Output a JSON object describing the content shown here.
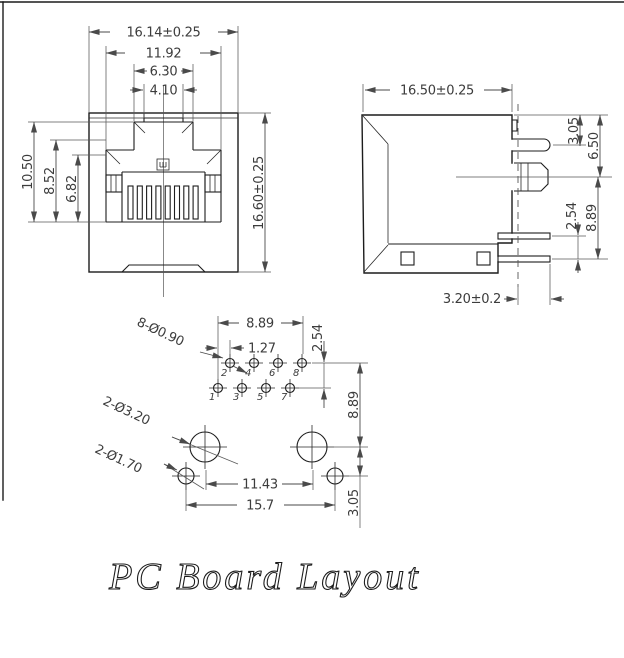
{
  "drawing": {
    "title": "PC Board Layout",
    "front_view": {
      "dim_width_outer": "16.14±0.25",
      "dim_width_opening": "11.92",
      "dim_width_key": "6.30",
      "dim_width_latch": "4.10",
      "dim_height_opening": "10.50",
      "dim_height_step": "8.52",
      "dim_height_cavity": "6.82",
      "dim_height_outer": "16.60±0.25"
    },
    "side_view": {
      "dim_depth": "16.50±0.25",
      "dim_top_to_latch": "3.05",
      "dim_top_to_stop": "6.50",
      "dim_pin_pitch": "2.54",
      "dim_stop_to_pin": "8.89",
      "dim_pin_protrusion": "3.20±0.2"
    },
    "board_layout": {
      "callout_contact_holes": "8-Ø0.90",
      "callout_post_holes": "2-Ø3.20",
      "callout_peg_holes": "2-Ø1.70",
      "dim_contact_span": "8.89",
      "dim_contact_stagger": "1.27",
      "dim_row_pitch": "2.54",
      "dim_row_to_posts": "8.89",
      "dim_post_span": "11.43",
      "dim_peg_span": "15.7",
      "dim_post_to_peg": "3.05",
      "pin_numbers_top": [
        "2",
        "4",
        "6",
        "8"
      ],
      "pin_numbers_bottom": [
        "1",
        "3",
        "5",
        "7"
      ]
    },
    "colors": {
      "line": "#1c1c1c",
      "dim": "#4a4a4a",
      "background": "#ffffff"
    }
  }
}
